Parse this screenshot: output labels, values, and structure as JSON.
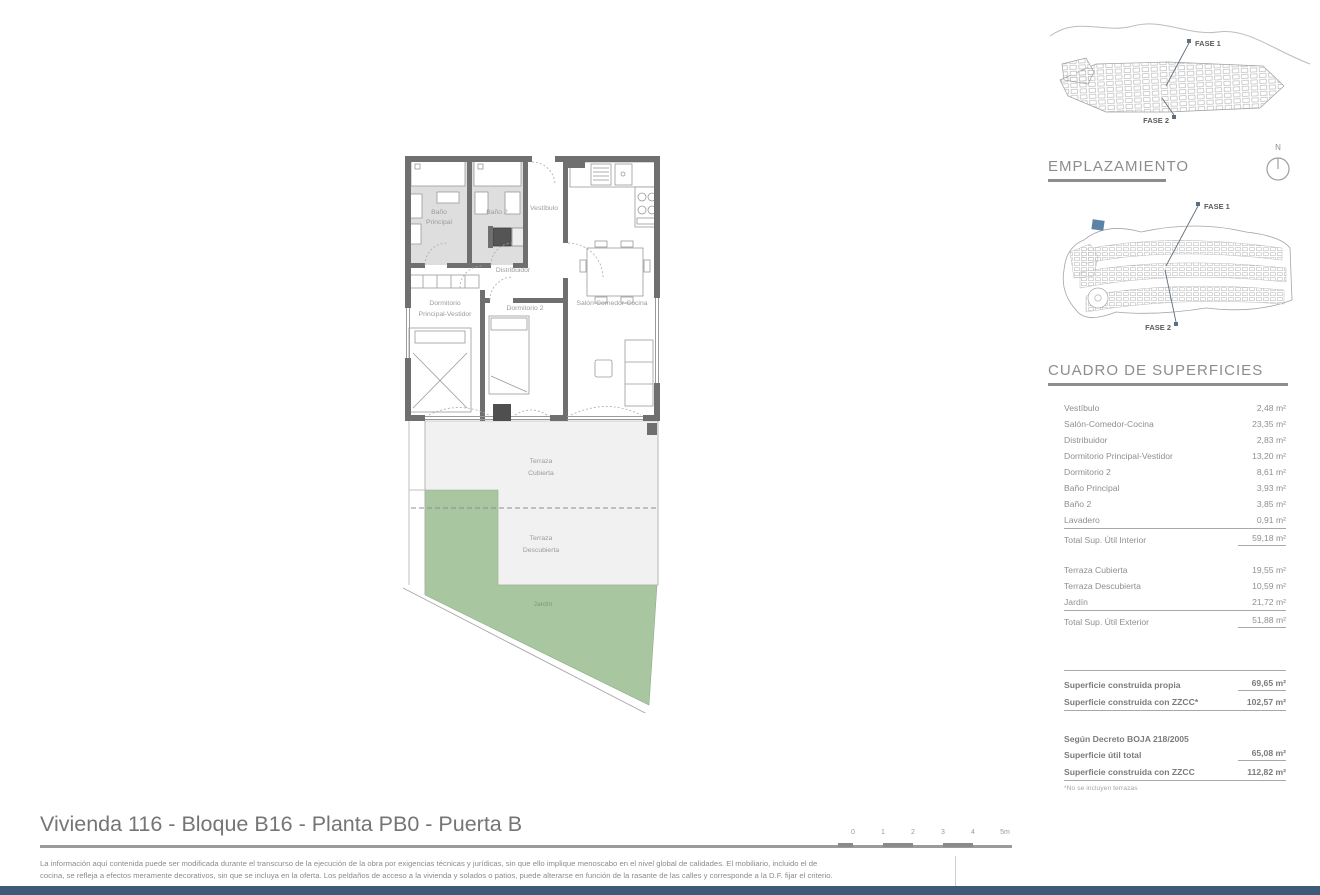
{
  "colors": {
    "wall_gray": "#6f6f6f",
    "bath_floor_gray": "#dedede",
    "terrace_gray": "#f1f1f1",
    "garden_green": "#a8c7a0",
    "bottom_bar_navy": "#3d5a78",
    "site_highlight_blue": "#5c83a6",
    "text_gray": "#8f8f8f"
  },
  "plan_labels": {
    "bano_principal_1": "Baño",
    "bano_principal_2": "Principal",
    "bano2": "Baño 2",
    "vestibulo": "Vestíbulo",
    "distribuidor": "Distribuidor",
    "dorm_ppal_1": "Dormitorio",
    "dorm_ppal_2": "Principal-Vestidor",
    "dorm2": "Dormitorio 2",
    "salon": "Salón-Comedor-Cocina",
    "terraza_cubierta_1": "Terraza",
    "terraza_cubierta_2": "Cubierta",
    "terraza_descubierta_1": "Terraza",
    "terraza_descubierta_2": "Descubierta",
    "jardin": "Jardín"
  },
  "aerial": {
    "fase1": "FASE 1",
    "fase2": "FASE 2"
  },
  "siteplan": {
    "title": "EMPLAZAMIENTO",
    "compass_n": "N",
    "fase1": "FASE 1",
    "fase2": "FASE 2"
  },
  "surfaces": {
    "title": "CUADRO DE SUPERFICIES",
    "interior_rows": [
      {
        "label": "Vestíbulo",
        "value": "2,48 m²"
      },
      {
        "label": "Salón-Comedor-Cocina",
        "value": "23,35 m²"
      },
      {
        "label": "Distribuidor",
        "value": "2,83 m²"
      },
      {
        "label": "Dormitorio Principal-Vestidor",
        "value": "13,20 m²"
      },
      {
        "label": "Dormitorio 2",
        "value": "8,61 m²"
      },
      {
        "label": "Baño Principal",
        "value": "3,93 m²"
      },
      {
        "label": "Baño 2",
        "value": "3,85 m²"
      },
      {
        "label": "Lavadero",
        "value": "0,91 m²"
      }
    ],
    "interior_total": {
      "label": "Total Sup. Útil Interior",
      "value": "59,18 m²"
    },
    "exterior_rows": [
      {
        "label": "Terraza Cubierta",
        "value": "19,55 m²"
      },
      {
        "label": "Terraza Descubierta",
        "value": "10,59 m²"
      },
      {
        "label": "Jardín",
        "value": "21,72 m²"
      }
    ],
    "exterior_total": {
      "label": "Total Sup. Útil Exterior",
      "value": "51,88 m²"
    },
    "built_rows": [
      {
        "label": "Superficie construida propia",
        "value": "69,65 m²"
      },
      {
        "label": "Superficie construida con ZZCC*",
        "value": "102,57 m²"
      }
    ],
    "decree_heading": "Según Decreto BOJA 218/2005",
    "decree_rows": [
      {
        "label": "Superficie útil total",
        "value": "65,08 m²"
      },
      {
        "label": "Superficie construida con ZZCC",
        "value": "112,82 m²"
      }
    ],
    "footnote": "*No se incluyen terrazas"
  },
  "footer": {
    "title": "Vivienda 116 - Bloque B16 - Planta PB0 - Puerta B",
    "scale_ticks": [
      "0",
      "1",
      "2",
      "3",
      "4",
      "5m"
    ],
    "legal_line1": "La información aquí contenida puede  ser modificada durante el transcurso de la ejecución de la obra por exigencias técnicas y jurídicas,  sin  que  ello  implique  menoscabo  en el nivel global de calidades.  El  mobiliario, incluido el de",
    "legal_line2": "cocina, se refleja a efectos meramente decorativos, sin que se incluya en la oferta. Los peldaños de acceso a la vivienda y  solados  o patios,  puede alterarse  en función de la rasante de las calles y corresponde a  la  D.F.  fijar el criterio."
  }
}
